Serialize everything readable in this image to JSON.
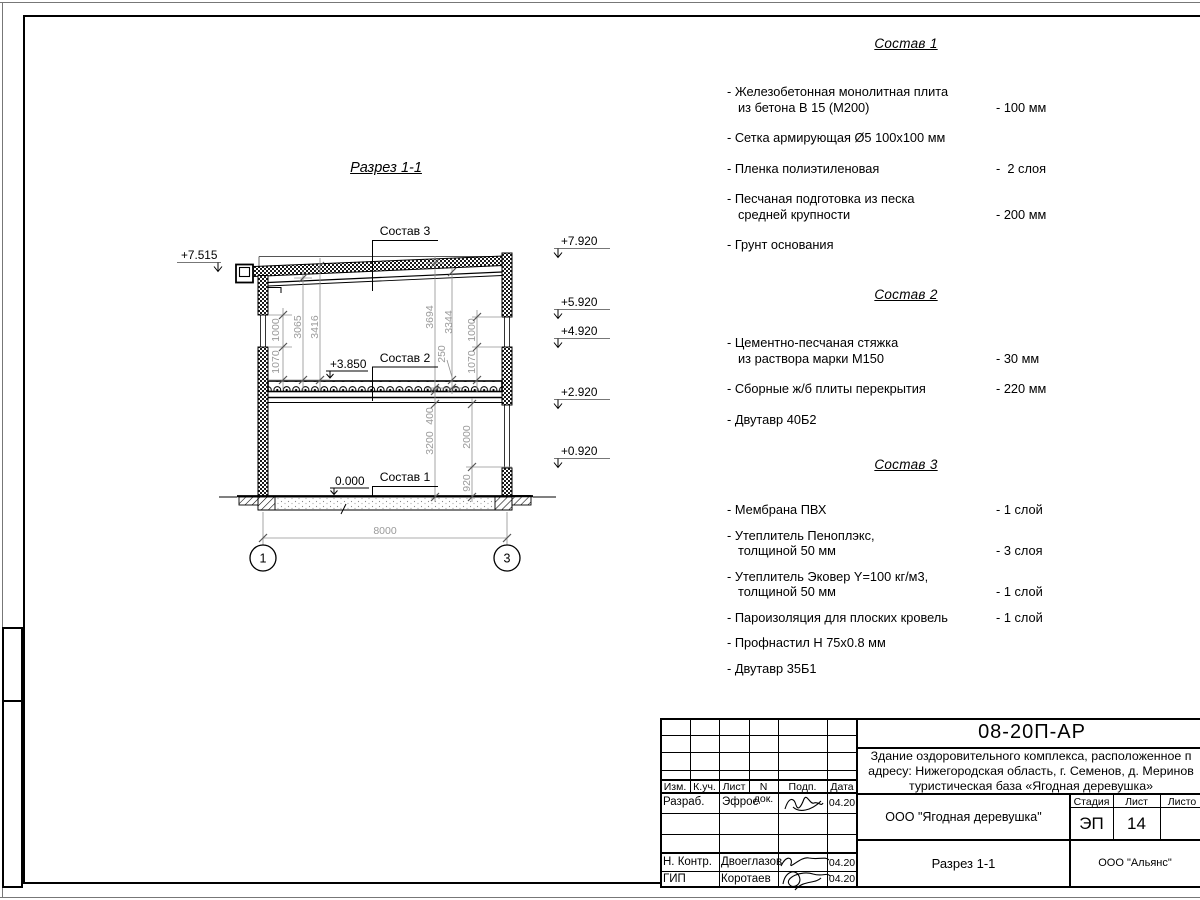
{
  "section": {
    "title": "Разрез 1-1",
    "labels": {
      "s1": "Состав 1",
      "s2": "Состав 2",
      "s3": "Состав 3"
    },
    "levels": {
      "left_top": "+7.515",
      "mid": "+3.850",
      "zero": "0.000",
      "r1": "+7.920",
      "r2": "+5.920",
      "r3": "+4.920",
      "r4": "+2.920",
      "r5": "+0.920"
    },
    "dims": {
      "l1000": "1000",
      "l1070": "1070",
      "d3065": "3065",
      "d3416": "3416",
      "d3694": "3694",
      "d3344": "3344",
      "d250": "250",
      "r1000": "1000",
      "r1070": "1070",
      "d400": "400",
      "d3200": "3200",
      "d2000": "2000",
      "d920": "920",
      "width": "8000"
    },
    "axes": {
      "a1": "1",
      "a3": "3"
    }
  },
  "compositions": [
    {
      "title": "Состав 1",
      "items": [
        {
          "name": "- Железобетонная  монолитная плита\nиз бетона В 15 (М200)",
          "value": "- 100 мм"
        },
        {
          "name": "- Сетка армирующая Ø5 100x100 мм",
          "value": ""
        },
        {
          "name": "- Пленка полиэтиленовая",
          "value": "-  2 слоя"
        },
        {
          "name": "- Песчаная подготовка из песка\nсредней крупности",
          "value": "- 200 мм"
        },
        {
          "name": "- Грунт основания",
          "value": ""
        }
      ]
    },
    {
      "title": "Состав 2",
      "items": [
        {
          "name": "- Цементно-песчаная стяжка\nиз раствора марки М150",
          "value": "- 30 мм"
        },
        {
          "name": "- Сборные ж/б плиты перекрытия",
          "value": "- 220 мм"
        },
        {
          "name": "- Двутавр 40Б2",
          "value": ""
        }
      ]
    },
    {
      "title": "Состав 3",
      "items": [
        {
          "name": "- Мембрана ПВХ",
          "value": "- 1 слой"
        },
        {
          "name": "- Утеплитель Пеноплэкс,\nтолщиной 50 мм",
          "value": "- 3 слоя"
        },
        {
          "name": "- Утеплитель Эковер Y=100 кг/м3,\nтолщиной 50 мм",
          "value": "- 1 слой"
        },
        {
          "name": "- Пароизоляция для плоских кровель",
          "value": "- 1 слой"
        },
        {
          "name": "- Профнастил Н 75x0.8 мм",
          "value": ""
        },
        {
          "name": "- Двутавр 35Б1",
          "value": ""
        }
      ]
    }
  ],
  "titleblock": {
    "doc_number": "08-20П-АР",
    "project": "Здание оздоровительного комплекса, расположенное п\nадресу: Нижегородская область, г. Семенов, д. Меринов\nтуристическая база «Ягодная деревушка»",
    "client": "ООО \"Ягодная деревушка\"",
    "drawing_name": "Разрез 1-1",
    "contractor": "ООО \"Альянс\"",
    "stage_label": "Стадия",
    "sheet_label": "Лист",
    "sheets_label": "Листо",
    "stage": "ЭП",
    "sheet_number": "14",
    "col_izm": "Изм.",
    "col_kuch": "К.уч.",
    "col_list": "Лист",
    "col_ndoc": "N док.",
    "col_podp": "Подп.",
    "col_data": "Дата",
    "r1_role": "Разраб.",
    "r1_name": "Эфрос",
    "r1_date": "04.20",
    "r2_role": "Н. Контр.",
    "r2_name": "Двоеглазов",
    "r2_date": "04.20",
    "r3_role": "ГИП",
    "r3_name": "Коротаев",
    "r3_date": "04.20"
  }
}
